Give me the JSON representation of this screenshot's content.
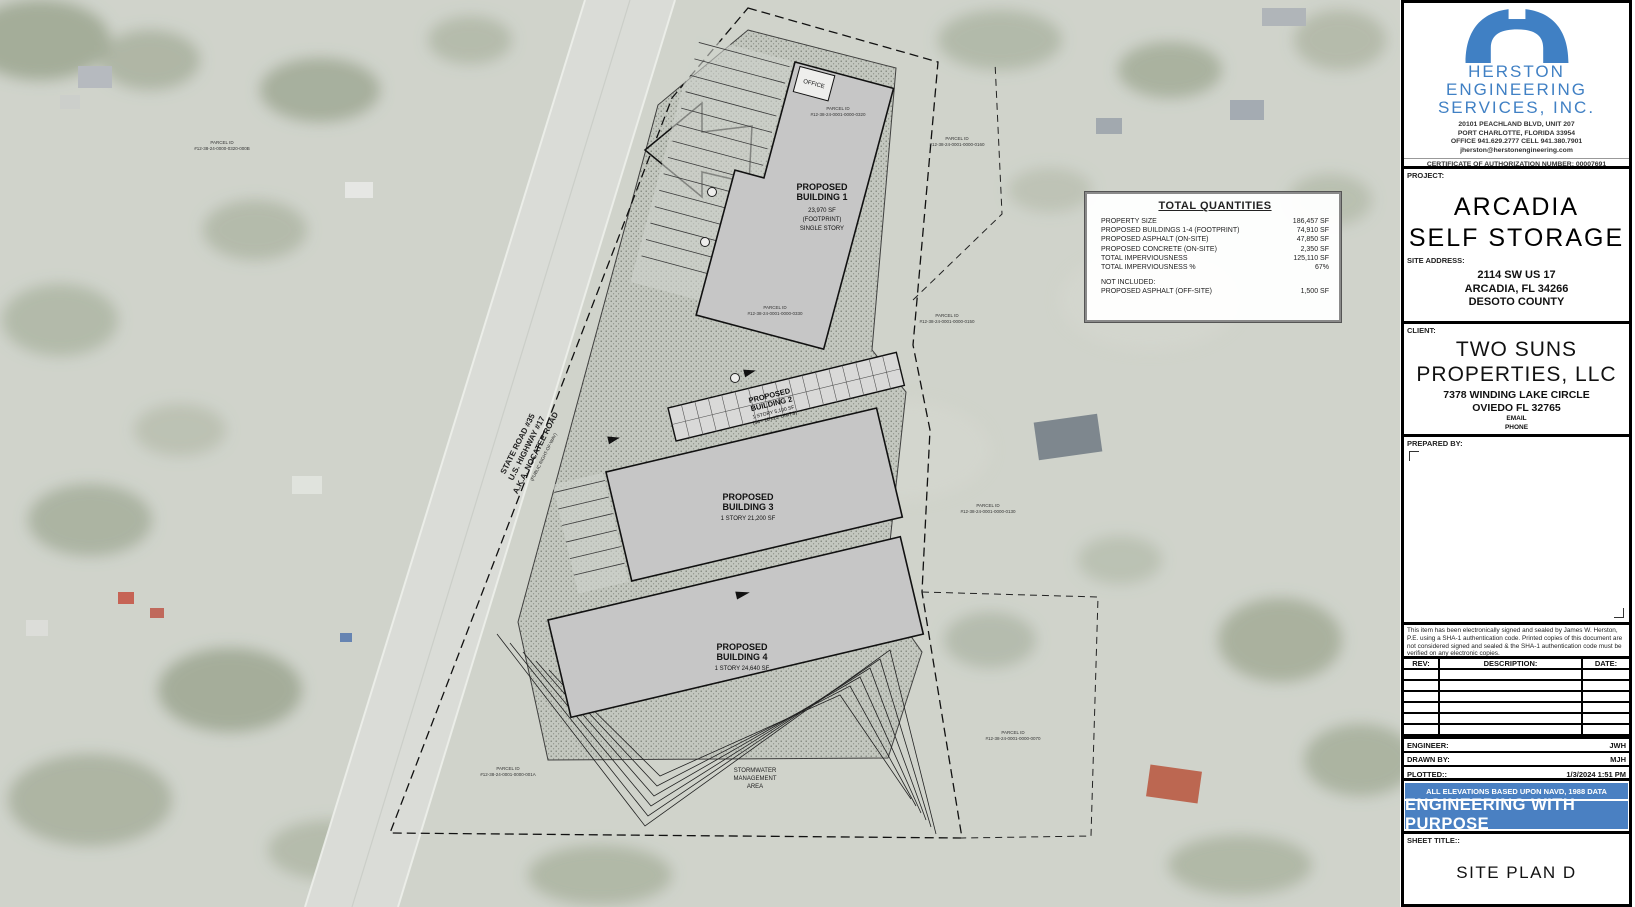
{
  "colors": {
    "brand_blue": "#4080c4",
    "bar_blue": "#4a80c2",
    "map_base": "#cbcfc6",
    "building_fill": "#c6c6c6"
  },
  "quantities_table": {
    "title": "TOTAL QUANTITIES",
    "rows": [
      {
        "label": "PROPERTY SIZE",
        "value": "186,457 SF"
      },
      {
        "label": "PROPOSED BUILDINGS 1-4 (FOOTPRINT)",
        "value": "74,910 SF"
      },
      {
        "label": "PROPOSED ASPHALT (ON-SITE)",
        "value": "47,850 SF"
      },
      {
        "label": "PROPOSED CONCRETE (ON-SITE)",
        "value": "2,350 SF"
      },
      {
        "label": "TOTAL IMPERVIOUSNESS",
        "value": "125,110 SF"
      },
      {
        "label": "TOTAL IMPERVIOUSNESS %",
        "value": "67%"
      }
    ],
    "not_included_label": "NOT INCLUDED:",
    "not_included_row": {
      "label": "PROPOSED ASPHALT (OFF-SITE)",
      "value": "1,500 SF"
    }
  },
  "site_plan": {
    "office_label": "OFFICE",
    "buildings": [
      {
        "line1": "PROPOSED",
        "line2": "BUILDING 1",
        "sub1": "23,970 SF",
        "sub2": "(FOOTPRINT)",
        "sub3": "SINGLE STORY"
      },
      {
        "line1": "PROPOSED",
        "line2": "BUILDING 2",
        "sub1": "1 STORY 5,100 SF",
        "sub2": "(34 - 10'x15' UNITS)"
      },
      {
        "line1": "PROPOSED",
        "line2": "BUILDING 3",
        "sub1": "1 STORY  21,200 SF"
      },
      {
        "line1": "PROPOSED",
        "line2": "BUILDING 4",
        "sub1": "1 STORY  24,640 SF"
      }
    ],
    "stormwater_label": {
      "l1": "STORMWATER",
      "l2": "MANAGEMENT",
      "l3": "AREA"
    },
    "road_label": {
      "l1": "STATE ROAD #35",
      "l2": "U.S. HIGHWAY #17",
      "l3": "A.K.A. NOCATEE ROAD",
      "l4": "(PUBLIC RIGHT-OF-WAY)"
    },
    "parcel_id_label": "PARCEL ID",
    "parcels": [
      {
        "id": "#12-38-24-0000-0320-000B"
      },
      {
        "id": "#12-38-24-0001-0000-0320"
      },
      {
        "id": "#12-38-24-0001-0000-0160"
      },
      {
        "id": "#12-38-24-0001-0000-0330"
      },
      {
        "id": "#12-38-24-0001-0000-0150"
      },
      {
        "id": "#12-38-24-0001-0000-0130"
      },
      {
        "id": "#12-38-24-0001-0000-0070"
      },
      {
        "id": "#12-38-24-0001-0000-001A"
      }
    ]
  },
  "title_block": {
    "company": {
      "name1": "HERSTON",
      "name2": "ENGINEERING",
      "name3": "SERVICES,  INC.",
      "address1": "20101 PEACHLAND BLVD, UNIT 207",
      "address2": "PORT  CHARLOTTE,  FLORIDA  33954",
      "phones": "OFFICE  941.629.2777   CELL 941.380.7901",
      "email": "jherston@herstonengineering.com",
      "certificate": "CERTIFICATE OF AUTHORIZATION NUMBER: 00007691"
    },
    "project": {
      "label": "PROJECT:",
      "name_line1": "ARCADIA",
      "name_line2": "SELF STORAGE",
      "site_address_label": "SITE ADDRESS:",
      "addr1": "2114 SW US 17",
      "addr2": "ARCADIA, FL 34266",
      "addr3": "DESOTO COUNTY"
    },
    "client": {
      "label": "CLIENT:",
      "name_line1": "TWO SUNS",
      "name_line2": "PROPERTIES, LLC",
      "addr1": "7378 WINDING LAKE CIRCLE",
      "addr2": "OVIEDO FL 32765",
      "email_label": "EMAIL",
      "phone_label": "PHONE"
    },
    "prepared_by_label": "PREPARED BY:",
    "signature_note": "This item has been electronically signed and sealed by James W. Herston, P.E. using a SHA-1 authentication code. Printed copies of this document are not considered signed and sealed & the SHA-1 authentication code must be verified on any electronic copies.",
    "revision_table": {
      "h0": "REV:",
      "h1": "DESCRIPTION:",
      "h2": "DATE:"
    },
    "info_rows": [
      {
        "label": "ENGINEER:",
        "value": "JWH"
      },
      {
        "label": "DRAWN BY:",
        "value": "MJH"
      },
      {
        "label": "PLOTTED::",
        "value": "1/3/2024 1:51 PM"
      }
    ],
    "elevations_note": "ALL ELEVATIONS BASED UPON NAVD, 1988 DATA",
    "motto": "ENGINEERING WITH PURPOSE",
    "sheet_label": "SHEET TITLE::",
    "sheet_title": "SITE PLAN D"
  }
}
